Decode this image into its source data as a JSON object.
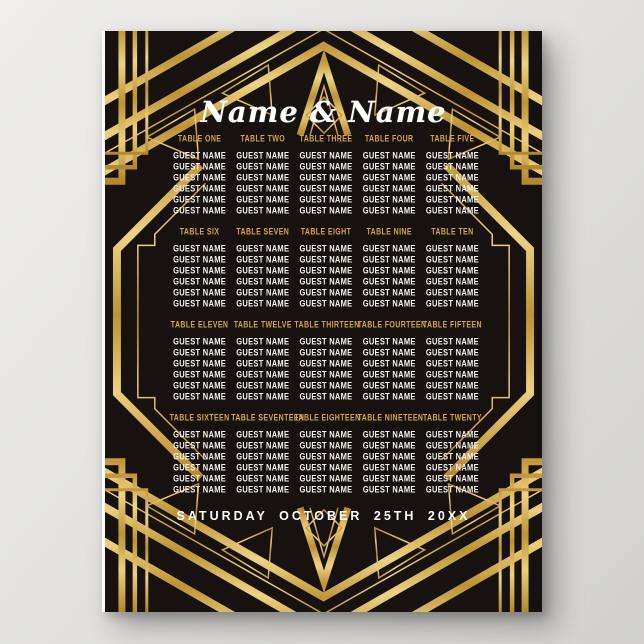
{
  "poster": {
    "couple_names": "Name & Name",
    "event_date": "SATURDAY OCTOBER 25TH 20XX",
    "guest_placeholder": "GUEST NAME",
    "guests_per_table": 6,
    "colors": {
      "gold": "#d2a646",
      "gold_light": "#ecd487",
      "gold_dark": "#b3872c",
      "ink": "#171210",
      "text_white": "#ffffff",
      "backdrop_gray": "#dddcda"
    },
    "tables": [
      {
        "label": "TABLE ONE",
        "guests": [
          "GUEST NAME",
          "GUEST NAME",
          "GUEST NAME",
          "GUEST NAME",
          "GUEST NAME",
          "GUEST NAME"
        ]
      },
      {
        "label": "TABLE TWO",
        "guests": [
          "GUEST NAME",
          "GUEST NAME",
          "GUEST NAME",
          "GUEST NAME",
          "GUEST NAME",
          "GUEST NAME"
        ]
      },
      {
        "label": "TABLE THREE",
        "guests": [
          "GUEST NAME",
          "GUEST NAME",
          "GUEST NAME",
          "GUEST NAME",
          "GUEST NAME",
          "GUEST NAME"
        ]
      },
      {
        "label": "TABLE FOUR",
        "guests": [
          "GUEST NAME",
          "GUEST NAME",
          "GUEST NAME",
          "GUEST NAME",
          "GUEST NAME",
          "GUEST NAME"
        ]
      },
      {
        "label": "TABLE FIVE",
        "guests": [
          "GUEST NAME",
          "GUEST NAME",
          "GUEST NAME",
          "GUEST NAME",
          "GUEST NAME",
          "GUEST NAME"
        ]
      },
      {
        "label": "TABLE SIX",
        "guests": [
          "GUEST NAME",
          "GUEST NAME",
          "GUEST NAME",
          "GUEST NAME",
          "GUEST NAME",
          "GUEST NAME"
        ]
      },
      {
        "label": "TABLE SEVEN",
        "guests": [
          "GUEST NAME",
          "GUEST NAME",
          "GUEST NAME",
          "GUEST NAME",
          "GUEST NAME",
          "GUEST NAME"
        ]
      },
      {
        "label": "TABLE EIGHT",
        "guests": [
          "GUEST NAME",
          "GUEST NAME",
          "GUEST NAME",
          "GUEST NAME",
          "GUEST NAME",
          "GUEST NAME"
        ]
      },
      {
        "label": "TABLE NINE",
        "guests": [
          "GUEST NAME",
          "GUEST NAME",
          "GUEST NAME",
          "GUEST NAME",
          "GUEST NAME",
          "GUEST NAME"
        ]
      },
      {
        "label": "TABLE TEN",
        "guests": [
          "GUEST NAME",
          "GUEST NAME",
          "GUEST NAME",
          "GUEST NAME",
          "GUEST NAME",
          "GUEST NAME"
        ]
      },
      {
        "label": "TABLE ELEVEN",
        "guests": [
          "GUEST NAME",
          "GUEST NAME",
          "GUEST NAME",
          "GUEST NAME",
          "GUEST NAME",
          "GUEST NAME"
        ]
      },
      {
        "label": "TABLE TWELVE",
        "guests": [
          "GUEST NAME",
          "GUEST NAME",
          "GUEST NAME",
          "GUEST NAME",
          "GUEST NAME",
          "GUEST NAME"
        ]
      },
      {
        "label": "TABLE THIRTEEN",
        "guests": [
          "GUEST NAME",
          "GUEST NAME",
          "GUEST NAME",
          "GUEST NAME",
          "GUEST NAME",
          "GUEST NAME"
        ]
      },
      {
        "label": "TABLE FOURTEEN",
        "guests": [
          "GUEST NAME",
          "GUEST NAME",
          "GUEST NAME",
          "GUEST NAME",
          "GUEST NAME",
          "GUEST NAME"
        ]
      },
      {
        "label": "TABLE FIFTEEN",
        "guests": [
          "GUEST NAME",
          "GUEST NAME",
          "GUEST NAME",
          "GUEST NAME",
          "GUEST NAME",
          "GUEST NAME"
        ]
      },
      {
        "label": "TABLE SIXTEEN",
        "guests": [
          "GUEST NAME",
          "GUEST NAME",
          "GUEST NAME",
          "GUEST NAME",
          "GUEST NAME",
          "GUEST NAME"
        ]
      },
      {
        "label": "TABLE SEVENTEEN",
        "guests": [
          "GUEST NAME",
          "GUEST NAME",
          "GUEST NAME",
          "GUEST NAME",
          "GUEST NAME",
          "GUEST NAME"
        ]
      },
      {
        "label": "TABLE EIGHTEEN",
        "guests": [
          "GUEST NAME",
          "GUEST NAME",
          "GUEST NAME",
          "GUEST NAME",
          "GUEST NAME",
          "GUEST NAME"
        ]
      },
      {
        "label": "TABLE NINETEEN",
        "guests": [
          "GUEST NAME",
          "GUEST NAME",
          "GUEST NAME",
          "GUEST NAME",
          "GUEST NAME",
          "GUEST NAME"
        ]
      },
      {
        "label": "TABLE TWENTY",
        "guests": [
          "GUEST NAME",
          "GUEST NAME",
          "GUEST NAME",
          "GUEST NAME",
          "GUEST NAME",
          "GUEST NAME"
        ]
      }
    ]
  }
}
